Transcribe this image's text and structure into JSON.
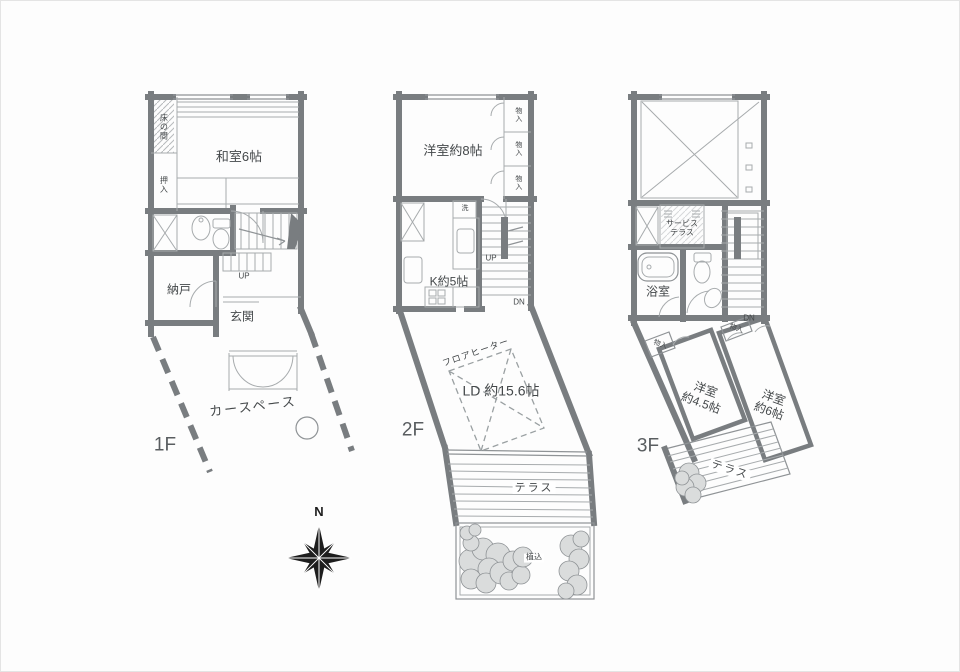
{
  "title": "3-story house floor plan",
  "colors": {
    "wall": "#797d80",
    "thin_line": "#a7abad",
    "text": "#44484a",
    "shrub_fill": "#dadcdc",
    "compass": "#1d1d1d",
    "background": "#fdfdfd"
  },
  "compass": {
    "label": "N"
  },
  "floors": [
    {
      "id": "1F",
      "label": "1F",
      "rooms": {
        "washitsu": "和室6帖",
        "tokonoma": "床の間",
        "oshiire": "押入",
        "nando": "納戸",
        "genkan": "玄関",
        "car_space": "カースペース",
        "stairs_up": "UP"
      }
    },
    {
      "id": "2F",
      "label": "2F",
      "rooms": {
        "western8": "洋室約8帖",
        "monoire": "物入",
        "laundry": "洗",
        "kitchen": "K約5帖",
        "stairs_up": "UP",
        "stairs_dn": "DN",
        "floor_heater": "フロアヒーター",
        "living_dining": "LD 約15.6帖",
        "terrace": "テラス",
        "planting": "植込"
      }
    },
    {
      "id": "3F",
      "label": "3F",
      "rooms": {
        "service_terrace_line1": "サービス",
        "service_terrace_line2": "テラス",
        "bathroom": "浴室",
        "stairs_dn": "DN",
        "monoire": "物入",
        "western45_line1": "洋室",
        "western45_line2": "約4.5帖",
        "western6_line1": "洋室",
        "western6_line2": "約6帖",
        "terrace": "テラス"
      }
    }
  ]
}
